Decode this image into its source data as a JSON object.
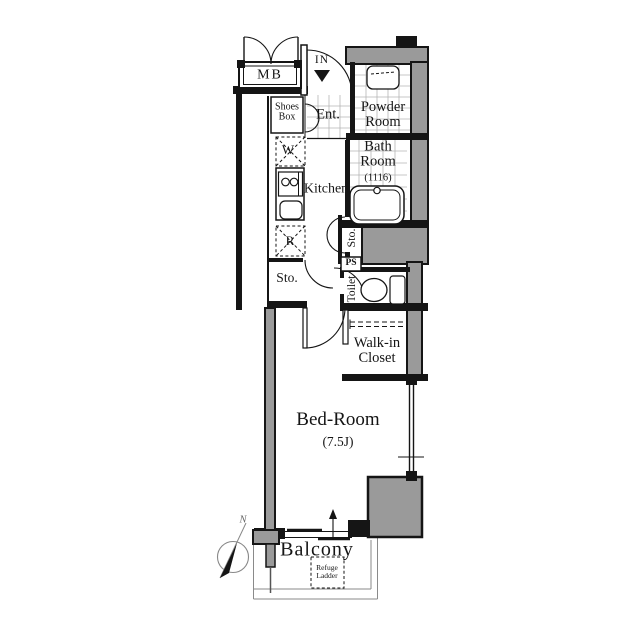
{
  "labels": {
    "mb": "MB",
    "in": "IN",
    "shoes1": "Shoes",
    "shoes2": "Box",
    "ent": "Ent.",
    "powder1": "Powder",
    "powder2": "Room",
    "bath1": "Bath",
    "bath2": "Room",
    "bath_size": "(1116)",
    "washer": "W",
    "kitchen": "Kitchen",
    "fridge": "R",
    "sto_right": "Sto.",
    "ps": "PS",
    "sto_left": "Sto.",
    "toilet": "Toilet",
    "wic1": "Walk-in",
    "wic2": "Closet",
    "bedroom": "Bed-Room",
    "bedroom_size": "(7.5J)",
    "balcony": "Balcony",
    "refuge1": "Refuge",
    "refuge2": "Ladder",
    "north": "N"
  },
  "colors": {
    "wall": "#151515",
    "gray_fill": "#9a9a9a",
    "tile_grid": "#b5b5b5",
    "balcony_line": "#8a8a8a"
  }
}
